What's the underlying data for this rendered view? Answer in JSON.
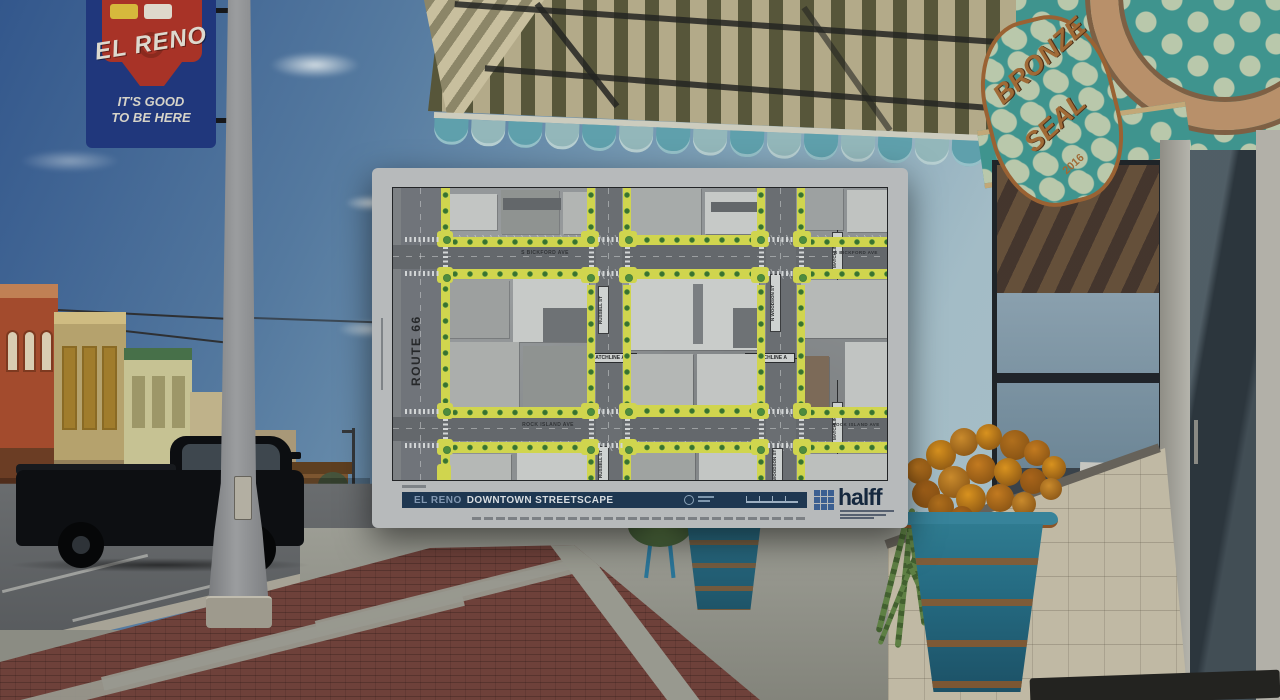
{
  "overlay_plan": {
    "title_label": "EL RENO",
    "title_main": "DOWNTOWN STREETSCAPE",
    "firm_logo": "halff",
    "note_box_title": "CONCEPTUAL NOTE",
    "street_labels": {
      "route_66": "ROUTE 66",
      "s_bickford_ave": "S BICKFORD AVE",
      "rock_island_ave": "ROCK ISLAND AVE",
      "russell_st": "RUSSELL ST",
      "n_woodson_st": "N WOODSON ST",
      "woodson_st": "WOODSON ST",
      "matchline_a": "MATCHLINE A",
      "matchline_d": "MATCHLINE D"
    },
    "colors": {
      "highlight_yellow": "#d0d54e",
      "tree_green": "#3a7231",
      "title_bar_navy": "#1e3751",
      "halff_blue": "#3b5f91"
    }
  },
  "photo": {
    "pole_banner": {
      "brand": "EL RENO",
      "tagline_1": "IT'S GOOD",
      "tagline_2": "TO BE HERE"
    },
    "window_sign": {
      "line1": "BRONZE",
      "line2": "SEAL",
      "year": "2016"
    }
  }
}
